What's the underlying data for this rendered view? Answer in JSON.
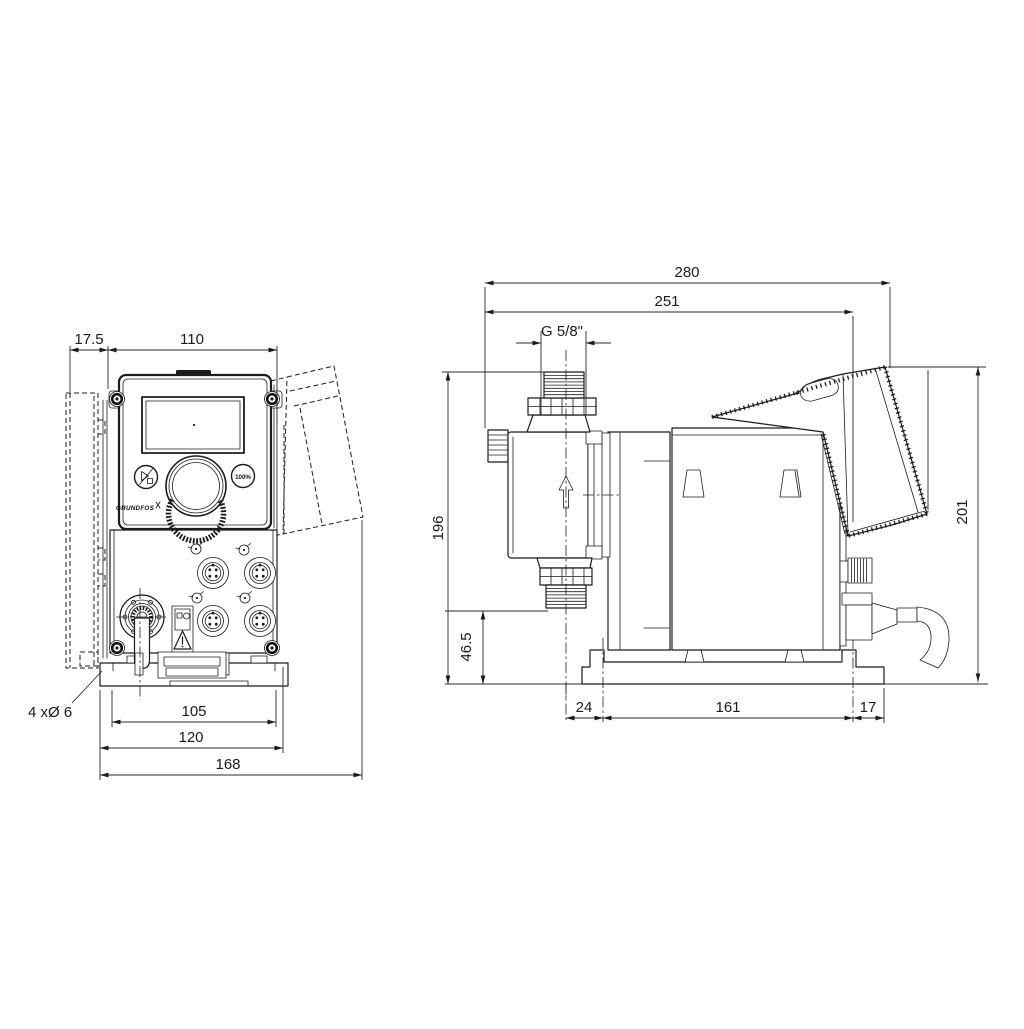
{
  "front_view": {
    "dims": {
      "wall_offset": "17.5",
      "panel_width": "110",
      "slot_span": "105",
      "plate_width": "120",
      "overall_width": "168"
    },
    "holes_note": "4 xØ 6",
    "panel": {
      "percent_button": "100%",
      "brand": "GRUNDFOS",
      "run_stop_icon": "run-stop-icon"
    }
  },
  "side_view": {
    "dims": {
      "overall_length": "280",
      "length_to_rear_hole": "251",
      "thread": "G 5/8\"",
      "height_to_connection": "196",
      "outlet_height": "46.5",
      "overall_height": "201",
      "front_offset": "24",
      "hole_spacing": "161",
      "rear_offset": "17"
    }
  },
  "colors": {
    "line": "#1c1c1c",
    "dimension": "#2a2a2a",
    "background": "#ffffff"
  }
}
